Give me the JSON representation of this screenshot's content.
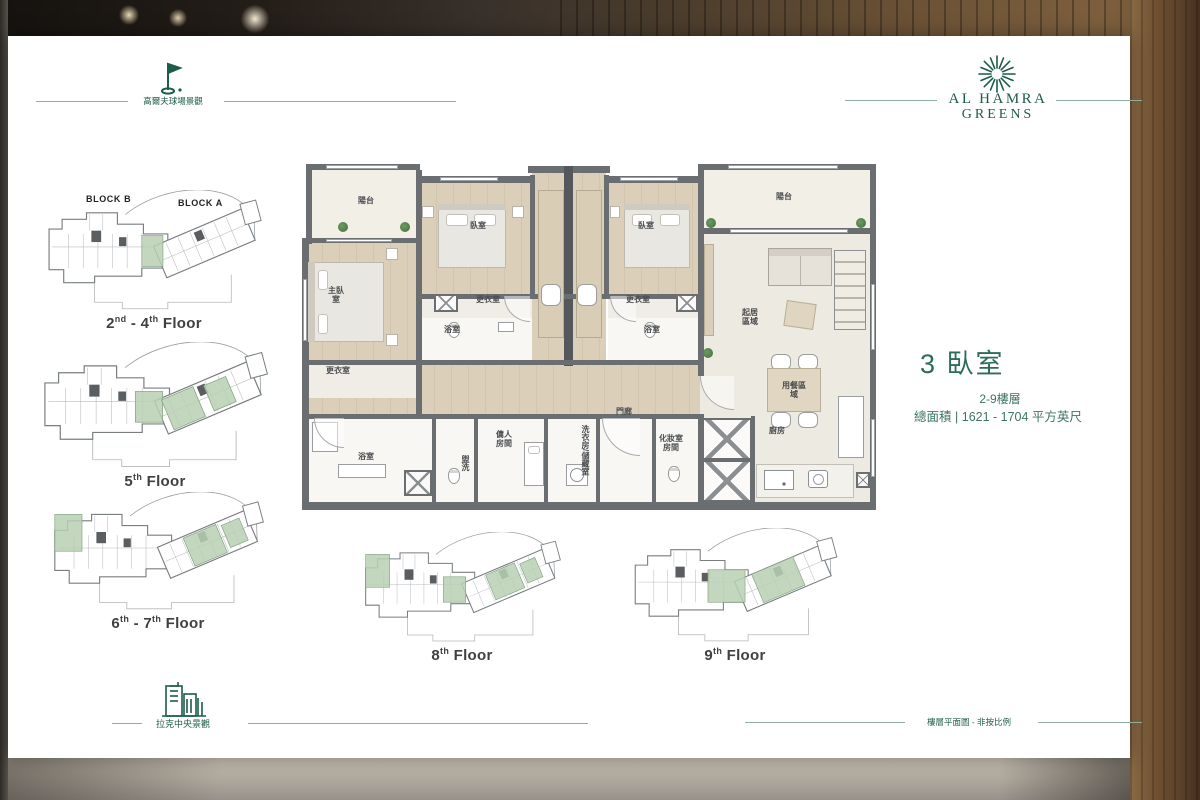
{
  "colors": {
    "brand_green": "#1d5c49",
    "title_green": "#2c6e55",
    "wall_gray": "#6a6e71",
    "highlight_green": "#b9d0b4",
    "wood_floor": "#d9cdb8"
  },
  "header": {
    "golf_label": "高爾夫球場景觀"
  },
  "brand": {
    "line1": "AL HAMRA",
    "line2": "GREENS"
  },
  "unit_info": {
    "title": "3 臥室",
    "floors": "2-9樓層",
    "area": "總面積 | 1621 - 1704 平方英尺"
  },
  "footer": {
    "city_label": "拉克中央景觀",
    "note": "樓層平面圖 - 非按比例"
  },
  "key_plan": {
    "block_b": "BLOCK B",
    "block_a": "BLOCK A",
    "plates": [
      {
        "t1": "2",
        "s1": "nd",
        "t2": " - 4",
        "s2": "th",
        "t3": " Floor"
      },
      {
        "t1": "5",
        "s1": "th",
        "t2": "",
        "s2": "",
        "t3": " Floor"
      },
      {
        "t1": "6",
        "s1": "th",
        "t2": " - 7",
        "s2": "th",
        "t3": " Floor"
      },
      {
        "t1": "8",
        "s1": "th",
        "t2": "",
        "s2": "",
        "t3": " Floor"
      },
      {
        "t1": "9",
        "s1": "th",
        "t2": "",
        "s2": "",
        "t3": " Floor"
      }
    ]
  },
  "plan_rooms": {
    "balcony": "陽台",
    "bedroom": "臥室",
    "master_bedroom": "主臥室",
    "dressing_room": "更衣室",
    "bathroom": "浴室",
    "living_area": "起居區域",
    "dining_area": "用餐區域",
    "foyer": "門廊",
    "powder": "盥洗",
    "maid_room": "傭人房間",
    "laundry_storage": "洗衣房/儲藏室",
    "powder_room": "化妝室房間",
    "kitchen": "廚房"
  }
}
